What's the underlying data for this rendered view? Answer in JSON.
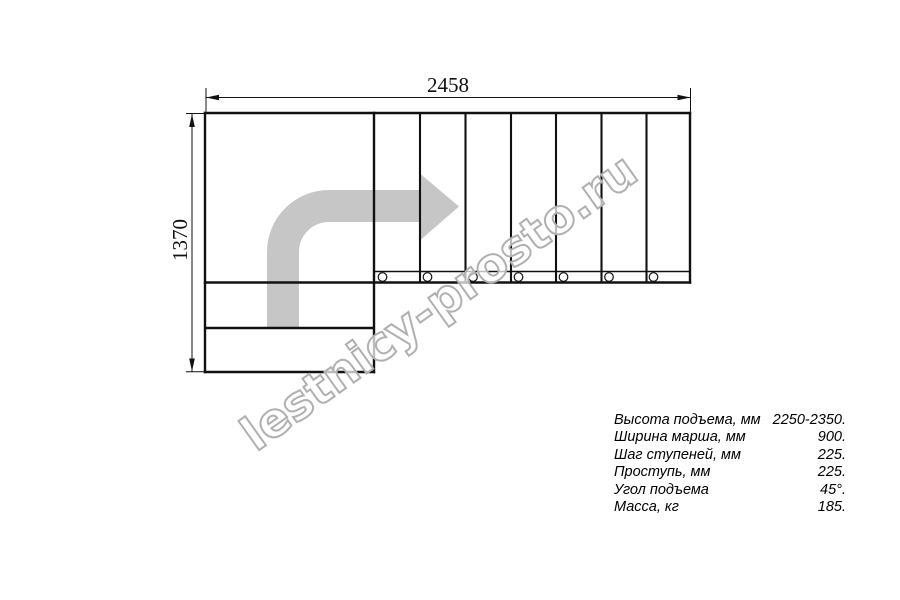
{
  "drawing": {
    "title": "L-shaped staircase plan view",
    "dim_width_label": "2458",
    "dim_height_label": "1370",
    "tread_count_main_flight": 7,
    "bottom_steps_count": 2,
    "baluster_count": 7
  },
  "specs": {
    "rows": [
      {
        "label": "Высота подъема, мм",
        "value": "2250-2350."
      },
      {
        "label": "Ширина марша, мм",
        "value": "900."
      },
      {
        "label": "Шаг ступеней, мм",
        "value": "225."
      },
      {
        "label": "Проступь, мм",
        "value": "225."
      },
      {
        "label": "Угол подъема",
        "value": "45°."
      },
      {
        "label": "Масса, кг",
        "value": "185."
      }
    ]
  },
  "watermark": {
    "text": "lestnicy-prosto.ru"
  },
  "colors": {
    "background": "#ffffff",
    "line": "#111111",
    "direction_arrow": "#c6c6c6",
    "watermark_outline": "#b0b0b0"
  }
}
